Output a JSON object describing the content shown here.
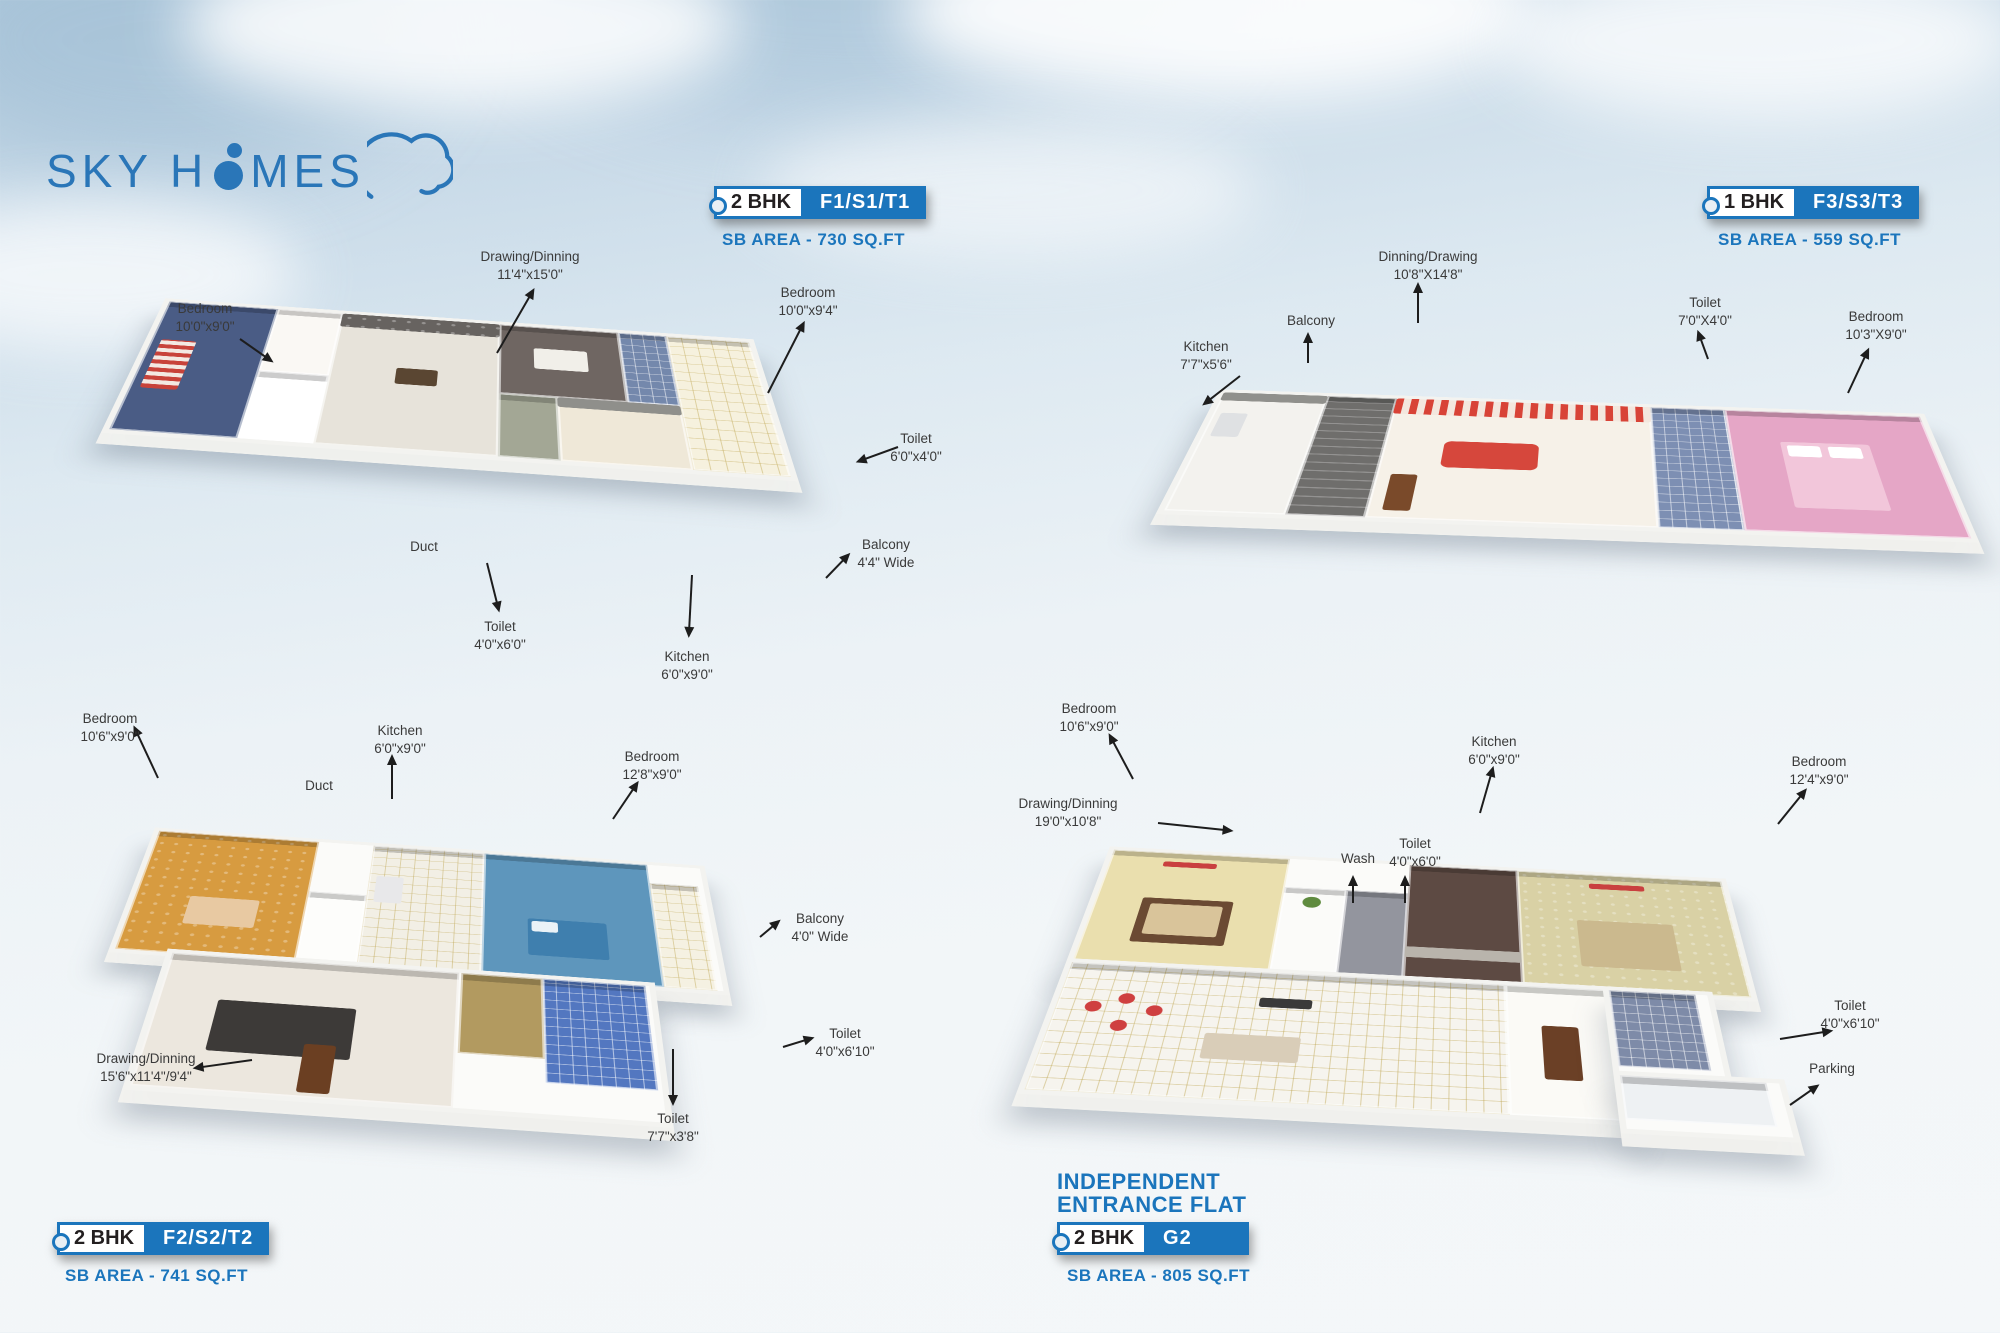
{
  "logo": {
    "text_before_o": "SKY H",
    "text_after_o": "MES"
  },
  "colors": {
    "accent_blue": "#1b75bc",
    "badge_text": "#231f20",
    "label_text": "#3a3a3a"
  },
  "plans": [
    {
      "position": "top-left",
      "bhk": "2 BHK",
      "code": "F1/S1/T1",
      "area": "SB AREA - 730 SQ.FT",
      "labels": [
        {
          "name": "Bedroom",
          "dims": "10'0\"x9'0\""
        },
        {
          "name": "Drawing/Dinning",
          "dims": "11'4\"x15'0\""
        },
        {
          "name": "Bedroom",
          "dims": "10'0\"x9'4\""
        },
        {
          "name": "Toilet",
          "dims": "6'0\"x4'0\""
        },
        {
          "name": "Balcony",
          "dims": "4'4\" Wide"
        },
        {
          "name": "Duct",
          "dims": ""
        },
        {
          "name": "Toilet",
          "dims": "4'0\"x6'0\""
        },
        {
          "name": "Kitchen",
          "dims": "6'0\"x9'0\""
        }
      ]
    },
    {
      "position": "top-right",
      "bhk": "1 BHK",
      "code": "F3/S3/T3",
      "area": "SB AREA - 559 SQ.FT",
      "labels": [
        {
          "name": "Kitchen",
          "dims": "7'7\"x5'6\""
        },
        {
          "name": "Balcony",
          "dims": ""
        },
        {
          "name": "Dinning/Drawing",
          "dims": "10'8\"X14'8\""
        },
        {
          "name": "Toilet",
          "dims": "7'0\"X4'0\""
        },
        {
          "name": "Bedroom",
          "dims": "10'3\"X9'0\""
        }
      ]
    },
    {
      "position": "bottom-left",
      "bhk": "2 BHK",
      "code": "F2/S2/T2",
      "area": "SB AREA - 741 SQ.FT",
      "labels": [
        {
          "name": "Bedroom",
          "dims": "10'6\"x9'0\""
        },
        {
          "name": "Kitchen",
          "dims": "6'0\"x9'0\""
        },
        {
          "name": "Duct",
          "dims": ""
        },
        {
          "name": "Bedroom",
          "dims": "12'8\"x9'0\""
        },
        {
          "name": "Balcony",
          "dims": "4'0\" Wide"
        },
        {
          "name": "Toilet",
          "dims": "4'0\"x6'10\""
        },
        {
          "name": "Toilet",
          "dims": "7'7\"x3'8\""
        },
        {
          "name": "Drawing/Dinning",
          "dims": "15'6\"x11'4\"/9'4\""
        }
      ]
    },
    {
      "position": "bottom-right",
      "title_line1": "INDEPENDENT",
      "title_line2": "ENTRANCE FLAT",
      "bhk": "2 BHK",
      "code": "G2",
      "area": "SB AREA - 805 SQ.FT",
      "labels": [
        {
          "name": "Bedroom",
          "dims": "10'6\"x9'0\""
        },
        {
          "name": "Kitchen",
          "dims": "6'0\"x9'0\""
        },
        {
          "name": "Wash",
          "dims": ""
        },
        {
          "name": "Toilet",
          "dims": "4'0\"x6'0\""
        },
        {
          "name": "Bedroom",
          "dims": "12'4\"x9'0\""
        },
        {
          "name": "Drawing/Dinning",
          "dims": "19'0\"x10'8\""
        },
        {
          "name": "Toilet",
          "dims": "4'0\"x6'10\""
        },
        {
          "name": "Parking",
          "dims": ""
        }
      ]
    }
  ]
}
